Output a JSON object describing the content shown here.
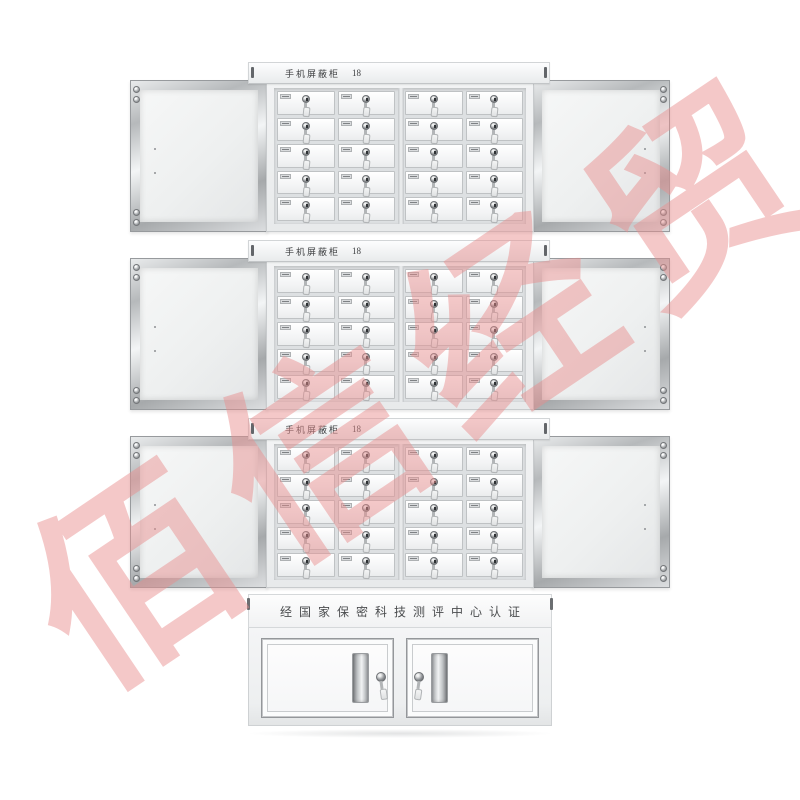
{
  "watermark": {
    "text": "佰信经贸",
    "color": "#e98e8e"
  },
  "cabinet": {
    "modules": [
      {
        "name_label": "手机屏蔽柜",
        "capacity_label": "18"
      },
      {
        "name_label": "手机屏蔽柜",
        "capacity_label": "18"
      },
      {
        "name_label": "手机屏蔽柜",
        "capacity_label": "18"
      }
    ],
    "locker_grid": {
      "rows": 5,
      "columns_per_half": 2,
      "halves_per_module": 2
    },
    "base": {
      "certification_label": "经国家保密科技测评中心认证"
    }
  }
}
